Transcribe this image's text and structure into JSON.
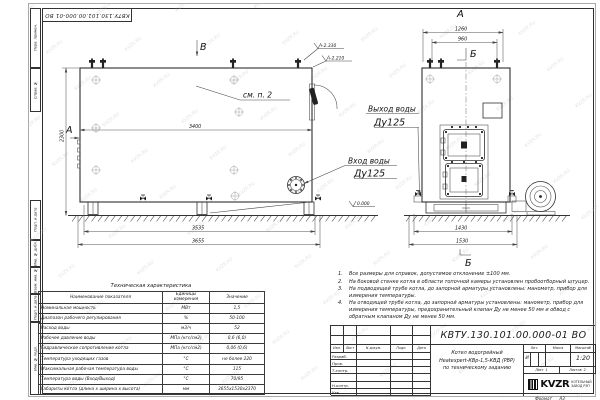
{
  "watermark": {
    "text": "KVZR.RU"
  },
  "top_stamp": {
    "doc_number": "КВТУ.130.101.00.000-01  ВО"
  },
  "margin_labels": [
    "Перв. примен.",
    "Справ. №",
    "Подп. и дата",
    "Инв. № дубл.",
    "Взам. инв. №",
    "Подп. и дата",
    "Инв. № подл."
  ],
  "drawing": {
    "side_view": {
      "marker_top": "В",
      "marker_left": "А",
      "note_ref": "см. п. 2",
      "dim_length_inner": "3400",
      "dim_height": "2300",
      "dim_supports": "3535",
      "dim_total": "3655",
      "level_top1": "+2.330",
      "level_top2": "+2.210",
      "level_zero": "0.000",
      "inlet_label": "Вход воды",
      "inlet_size": "Ду125"
    },
    "front_view": {
      "title": "А",
      "dim_top1": "1260",
      "dim_top2": "960",
      "marker_top": "Б",
      "marker_bottom": "Б",
      "dim_bottom1": "1430",
      "dim_bottom2": "1530",
      "outlet_label": "Выход воды",
      "outlet_size": "Ду125"
    }
  },
  "notes": [
    {
      "num": "1.",
      "text": "Все размеры для справок, допустимое отклонение ±100 мм."
    },
    {
      "num": "2.",
      "text": "На боковой стенке котла в области топочной камеры установлен пробоотборный штуцер."
    },
    {
      "num": "3.",
      "text": "На подводящей трубе котла, до запорной арматуры установлены: манометр, прибор для измерения температуры."
    },
    {
      "num": "4.",
      "text": "На отводящей трубе котла, до запорной арматуры установлены: манометр, прибор для измерения температуры, предохранительный клапан Ду не менее 50 мм и обвод с обратным клапаном Ду не менее 50 мм."
    }
  ],
  "tech_table": {
    "title": "Техническая характеристика",
    "headers": [
      "Наименование показателя",
      "Единицы измерения",
      "Значение"
    ],
    "rows": [
      [
        "Номинальная мощность",
        "МВт",
        "1,5"
      ],
      [
        "Диапазон рабочего регулирования",
        "%",
        "50-100"
      ],
      [
        "Расход воды",
        "м3/ч",
        "52"
      ],
      [
        "Рабочее давление воды",
        "МПа (кгс/см2)",
        "0,6 (6,0)"
      ],
      [
        "Гидравлическое сопротивление котла",
        "МПа (кгс/см2)",
        "0,06 (0,6)"
      ],
      [
        "Температура уходящих газов",
        "°С",
        "не более 220"
      ],
      [
        "Максимальная рабочая температура воды",
        "°С",
        "115"
      ],
      [
        "Температура воды (Вход/Выход)",
        "°С",
        "70/95"
      ],
      [
        "Габариты котла (длина х ширина х высота)",
        "мм",
        "3655х1530х2370"
      ]
    ]
  },
  "title_block": {
    "doc_number": "КВТУ.130.101.00.000-01  ВО",
    "rev_headers": [
      "Изм.",
      "Лист",
      "N докум.",
      "Подп.",
      "Дата"
    ],
    "sign_rows": [
      "Разраб.",
      "Пров.",
      "Т.контр.",
      "",
      "Н.контр.",
      "Утв."
    ],
    "title_lines": [
      "Котел водогрейный",
      "Heatexpert-КВр-1,5-КВД (РВР)",
      "по техническому заданию"
    ],
    "lit_label": "Лит.",
    "lit_value": "И",
    "mass_label": "Масса",
    "scale_label": "Масштаб",
    "scale_value": "1:20",
    "sheet_label": "Лист",
    "sheet_value": "1",
    "sheets_label": "Листов",
    "sheets_value": "2",
    "logo_text": "KVZR",
    "company_lines": [
      "КОТЕЛЬНЫЙ",
      "ЗАВОД РЭП"
    ],
    "format_label": "Формат",
    "format_value": "А3"
  }
}
